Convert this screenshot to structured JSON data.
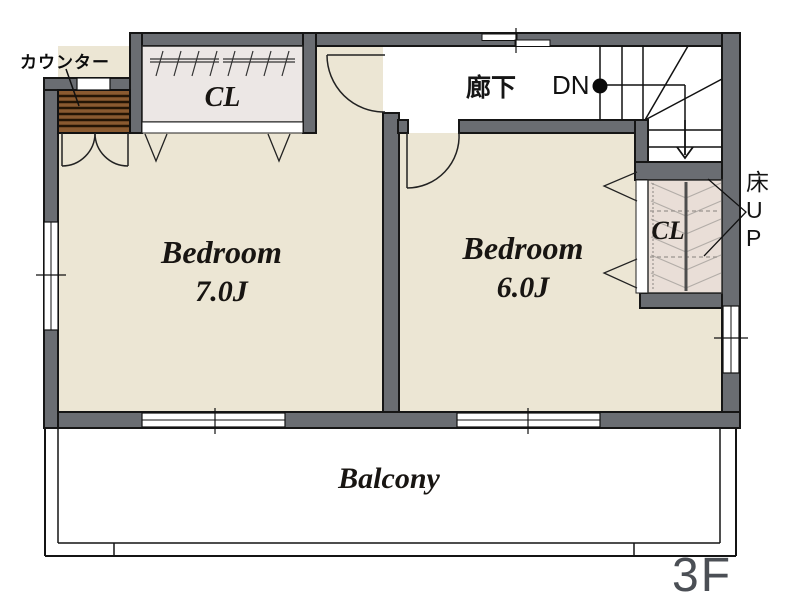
{
  "page": {
    "type": "floor-plan",
    "floor": "3F",
    "background": "#ffffff"
  },
  "colors": {
    "wall": "#6a6d72",
    "wall_outline": "#161616",
    "bedroom_floor": "#ece6d4",
    "closet_left_floor": "#ece7e5",
    "closet_right_floor": "#e9ded7",
    "counter_wood": "#8a5a30",
    "counter_wood_dark": "#241505",
    "hallway_floor": "#ffffff",
    "balcony_floor": "#ffffff",
    "floor_label_color": "#4b4f55"
  },
  "labels": {
    "counter": "カウンター",
    "closet_left": "CL",
    "hallway": "廊下",
    "stairs_down": "DN",
    "bedroom1": {
      "name": "Bedroom",
      "size": "7.0J"
    },
    "bedroom2": {
      "name": "Bedroom",
      "size": "6.0J"
    },
    "closet_right": "CL",
    "floor_up": {
      "full": "床UP",
      "lines": [
        "床",
        "U",
        "P"
      ]
    },
    "balcony": "Balcony",
    "floor": "3F"
  }
}
